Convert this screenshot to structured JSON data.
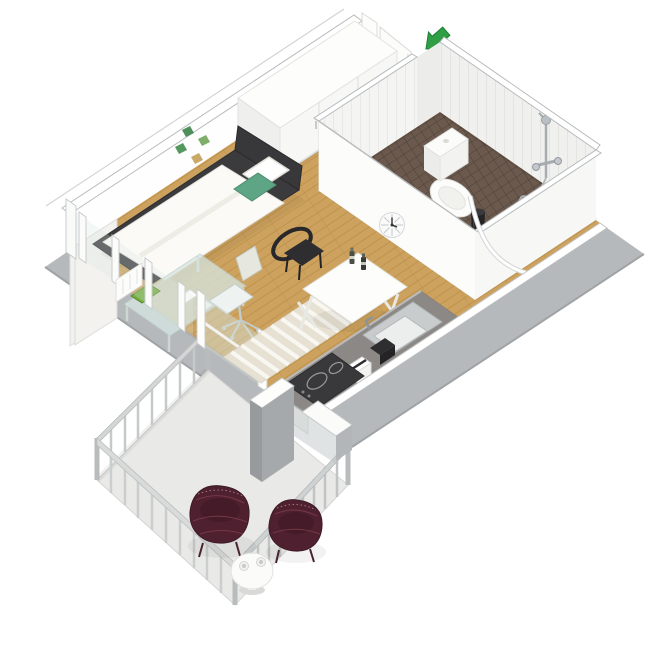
{
  "scene": {
    "type": "isometric-3d-floor-plan",
    "rooms": [
      "living-sleeping-area",
      "hallway",
      "bathroom",
      "kitchen",
      "balcony"
    ],
    "objects": [
      "entrance-arrow",
      "entrance-door",
      "wardrobe",
      "single-bed",
      "pillow",
      "accent-cushion",
      "wall-prints",
      "curtain-panel",
      "glass-desk",
      "desk-chair",
      "laptop",
      "radiator",
      "window-wall",
      "dining-table",
      "dining-chairs",
      "bottles",
      "wall-clock",
      "bathroom-door",
      "toilet",
      "shower-set",
      "shower-curtain-rail",
      "waste-bin",
      "kitchen-counter",
      "sink",
      "cooktop",
      "coffee-maker",
      "toaster",
      "striped-rug",
      "balcony-railing",
      "lounge-chairs",
      "side-table",
      "cups"
    ]
  },
  "entrance": {
    "arrow_icon": "arrow-down-left"
  },
  "colors": {
    "background": "#ffffff",
    "floor_wood": "#cda25e",
    "floor_wood_line": "#b3873f",
    "wall_white": "#fdfdfc",
    "wall_outline": "#b7bbbd",
    "exterior_gray": "#b6b9bb",
    "exterior_gray_dark": "#a0a4a6",
    "balcony_floor": "#e9e9e7",
    "railing_gray": "#c6c9c9",
    "bathroom_floor_tile": "#6b594d",
    "bathroom_wall": "#f4f4f2",
    "counter_top": "#8b8885",
    "cooktop_black": "#39393b",
    "appliance_black": "#2e2e30",
    "bed_frame": "#3b3b3d",
    "bedding_white": "#fbfaf7",
    "accent_green": "#5ea586",
    "arrow_green": "#2f9e44",
    "laptop_green": "#74ad3c",
    "chair_black": "#2e2e30",
    "lounge_maroon": "#4f2130",
    "rug_cream": "#e7e1d3",
    "glass_tint": "#d7e7e3",
    "chrome": "#a6acb0",
    "clock_face": "#fafafa"
  }
}
